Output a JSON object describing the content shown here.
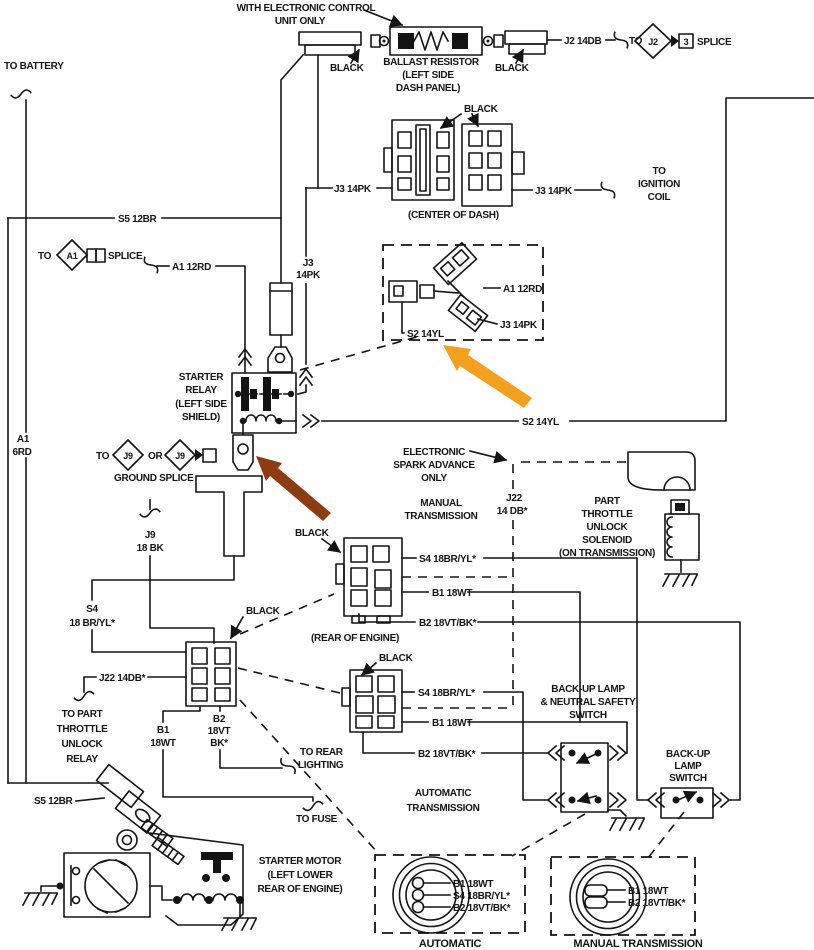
{
  "colors": {
    "line": "#141414",
    "background": "#ffffff",
    "orange_arrow": "#F4A01C",
    "brown_arrow": "#8E3B12"
  },
  "top": {
    "note1": "WITH ELECTRONIC CONTROL",
    "note2": "UNIT ONLY",
    "black_left": "BLACK",
    "ballast1": "BALLAST RESISTOR",
    "ballast2": "(LEFT SIDE",
    "ballast3": "DASH PANEL)",
    "black_right": "BLACK",
    "j2_wire": "J2 14DB",
    "to": "TO",
    "j2_diamond": "J2",
    "splice_num": "3",
    "splice": "SPLICE"
  },
  "dash": {
    "black": "BLACK",
    "j3_left": "J3 14PK",
    "j3_right": "J3 14PK",
    "coil1": "TO",
    "coil2": "IGNITION",
    "coil3": "COIL",
    "caption": "(CENTER OF DASH)"
  },
  "battery": {
    "to_battery": "TO BATTERY",
    "s5": "S5 12BR",
    "to": "TO",
    "a1_diamond": "A1",
    "splice": "SPLICE",
    "a1_wire": "A1 12RD",
    "a16rd1": "A1",
    "a16rd2": "6RD"
  },
  "relay": {
    "j3a": "J3",
    "j3b": "14PK",
    "cap1": "STARTER",
    "cap2": "RELAY",
    "cap3": "(LEFT SIDE",
    "cap4": "SHIELD)",
    "s2_wire": "S2 14YL"
  },
  "ground_splice": {
    "to": "TO",
    "j9a": "J9",
    "or": "OR",
    "j9b": "J9",
    "caption": "GROUND SPLICE"
  },
  "hbox": {
    "a1": "A1 12RD",
    "j3": "J3 14PK",
    "s2": "S2 14YL"
  },
  "esa": {
    "l1": "ELECTRONIC",
    "l2": "SPARK ADVANCE",
    "l3": "ONLY",
    "j22a": "J22",
    "j22b": "14 DB*"
  },
  "solenoid": {
    "l1": "PART",
    "l2": "THROTTLE",
    "l3": "UNLOCK",
    "l4": "SOLENOID",
    "l5": "(ON TRANSMISSION)"
  },
  "manual_conn": {
    "title1": "MANUAL",
    "title2": "TRANSMISSION",
    "black": "BLACK",
    "s4": "S4 18BR/YL*",
    "b1": "B1 18WT",
    "b2": "B2 18VT/BK*",
    "caption": "(REAR OF ENGINE)"
  },
  "left_conn": {
    "j9a": "J9",
    "j9b": "18 BK",
    "s4a": "S4",
    "s4b": "18 BR/YL*",
    "black": "BLACK",
    "j22": "J22 14DB*",
    "b1a": "B1",
    "b1b": "18WT",
    "b2a": "B2",
    "b2b": "18VT",
    "b2c": "BK*",
    "ptur1": "TO PART",
    "ptur2": "THROTTLE",
    "ptur3": "UNLOCK",
    "ptur4": "RELAY",
    "rear1": "TO REAR",
    "rear2": "LIGHTING"
  },
  "auto_conn": {
    "black": "BLACK",
    "s4": "S4 18BR/YL*",
    "b1": "B1 18WT",
    "b2": "B2 18VT/BK*",
    "caption1": "AUTOMATIC",
    "caption2": "TRANSMISSION"
  },
  "ns_switch": {
    "l1": "BACK-UP LAMP",
    "l2": "& NEUTRAL SAFETY",
    "l3": "SWITCH"
  },
  "bu_switch": {
    "l1": "BACK-UP",
    "l2": "LAMP",
    "l3": "SWITCH"
  },
  "bottom": {
    "s5": "S5 12BR",
    "to_fuse": "TO FUSE",
    "sm1": "STARTER MOTOR",
    "sm2": "(LEFT LOWER",
    "sm3": "REAR OF ENGINE)"
  },
  "auto_box": {
    "b1": "B1 18WT",
    "s4": "S4 18BR/YL*",
    "b2": "B2 18VT/BK*",
    "caption": "AUTOMATIC"
  },
  "man_box": {
    "b1": "B1 18WT",
    "b2": "B2 18VT/BK*",
    "caption": "MANUAL TRANSMISSION"
  }
}
